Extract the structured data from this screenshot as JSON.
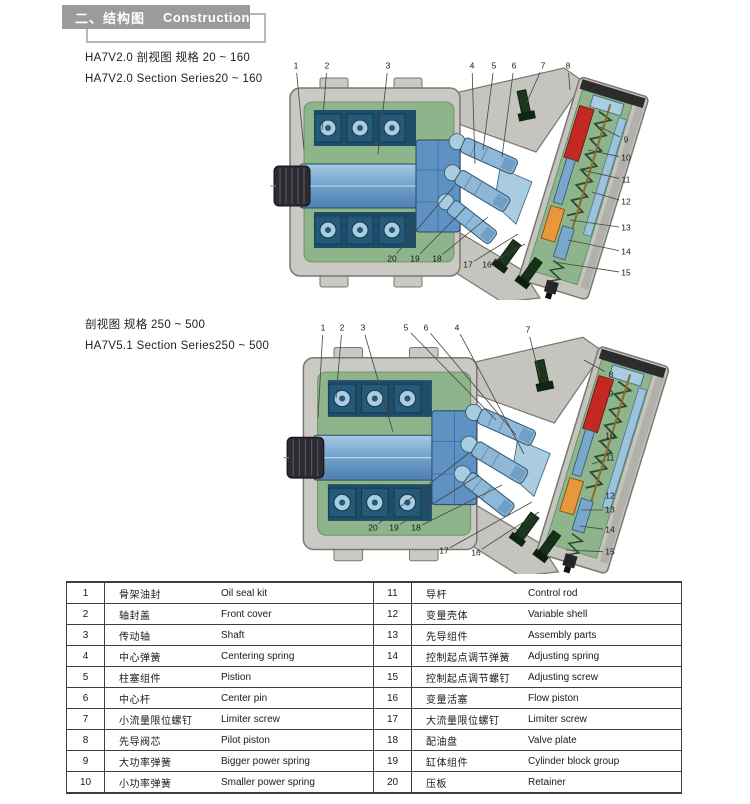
{
  "header": {
    "title_cn": "二、结构图",
    "title_en": "Construction",
    "box_color": "#9b9b9b"
  },
  "colors": {
    "housing_gray": "#cbc9c3",
    "interior_green": "#8db48a",
    "cylinder_blue": "#6f9fcb",
    "piston_lightblue": "#a9cce0",
    "spring_red": "#c32822",
    "piston_orange": "#e8973a",
    "bolt_darkgreen": "#1d351d"
  },
  "diagrams": [
    {
      "title_line1": "HA7V2.0 剖视图 规格 20 ~ 160",
      "title_line2": "HA7V2.0 Section Series20 ~ 160",
      "callouts": [
        {
          "label": "1",
          "nx": 26,
          "ny": 14,
          "tx": 34,
          "ty": 98
        },
        {
          "label": "2",
          "nx": 57,
          "ny": 14,
          "tx": 52,
          "ty": 78
        },
        {
          "label": "3",
          "nx": 118,
          "ny": 14,
          "tx": 108,
          "ty": 102
        },
        {
          "label": "4",
          "nx": 202,
          "ny": 14,
          "tx": 205,
          "ty": 112
        },
        {
          "label": "5",
          "nx": 224,
          "ny": 14,
          "tx": 213,
          "ty": 98
        },
        {
          "label": "6",
          "nx": 244,
          "ny": 14,
          "tx": 232,
          "ty": 105
        },
        {
          "label": "7",
          "nx": 273,
          "ny": 14,
          "tx": 256,
          "ty": 52
        },
        {
          "label": "8",
          "nx": 298,
          "ny": 14,
          "tx": 300,
          "ty": 38
        },
        {
          "label": "9",
          "nx": 356,
          "ny": 88,
          "tx": 330,
          "ty": 75
        },
        {
          "label": "10",
          "nx": 356,
          "ny": 106,
          "tx": 318,
          "ty": 98
        },
        {
          "label": "11",
          "nx": 356,
          "ny": 128,
          "tx": 312,
          "ty": 118
        },
        {
          "label": "12",
          "nx": 356,
          "ny": 150,
          "tx": 322,
          "ty": 140
        },
        {
          "label": "13",
          "nx": 356,
          "ny": 176,
          "tx": 300,
          "ty": 168
        },
        {
          "label": "14",
          "nx": 356,
          "ny": 200,
          "tx": 298,
          "ty": 188
        },
        {
          "label": "15",
          "nx": 356,
          "ny": 221,
          "tx": 284,
          "ty": 210
        },
        {
          "label": "20",
          "nx": 122,
          "ny": 207,
          "tx": 185,
          "ty": 133
        },
        {
          "label": "19",
          "nx": 145,
          "ny": 207,
          "tx": 196,
          "ty": 155
        },
        {
          "label": "18",
          "nx": 167,
          "ny": 207,
          "tx": 218,
          "ty": 165
        },
        {
          "label": "17",
          "nx": 198,
          "ny": 213,
          "tx": 248,
          "ty": 182
        },
        {
          "label": "16",
          "nx": 217,
          "ny": 213,
          "tx": 255,
          "ty": 192
        }
      ]
    },
    {
      "title_line1": "剖视图 规格 250 ~ 500",
      "title_line2": "HA7V5.1 Section Series250 ~ 500",
      "callouts": [
        {
          "label": "1",
          "nx": 45,
          "ny": 14,
          "tx": 40,
          "ty": 104
        },
        {
          "label": "2",
          "nx": 64,
          "ny": 14,
          "tx": 58,
          "ty": 84
        },
        {
          "label": "3",
          "nx": 85,
          "ny": 14,
          "tx": 115,
          "ty": 118
        },
        {
          "label": "5",
          "nx": 128,
          "ny": 14,
          "tx": 218,
          "ty": 106
        },
        {
          "label": "6",
          "nx": 148,
          "ny": 14,
          "tx": 238,
          "ty": 121
        },
        {
          "label": "4",
          "nx": 179,
          "ny": 14,
          "tx": 246,
          "ty": 140
        },
        {
          "label": "7",
          "nx": 250,
          "ny": 16,
          "tx": 262,
          "ty": 64
        },
        {
          "label": "8",
          "nx": 333,
          "ny": 61,
          "tx": 306,
          "ty": 46
        },
        {
          "label": "9",
          "nx": 333,
          "ny": 80,
          "tx": 328,
          "ty": 84
        },
        {
          "label": "10",
          "nx": 332,
          "ny": 122,
          "tx": 320,
          "ty": 128
        },
        {
          "label": "11",
          "nx": 332,
          "ny": 144,
          "tx": 314,
          "ty": 150
        },
        {
          "label": "12",
          "nx": 332,
          "ny": 182,
          "tx": 328,
          "ty": 176
        },
        {
          "label": "13",
          "nx": 332,
          "ny": 196,
          "tx": 303,
          "ty": 196
        },
        {
          "label": "14",
          "nx": 332,
          "ny": 216,
          "tx": 302,
          "ty": 212
        },
        {
          "label": "15",
          "nx": 332,
          "ny": 238,
          "tx": 288,
          "ty": 236
        },
        {
          "label": "20",
          "nx": 95,
          "ny": 214,
          "tx": 191,
          "ty": 139
        },
        {
          "label": "19",
          "nx": 116,
          "ny": 214,
          "tx": 201,
          "ty": 161
        },
        {
          "label": "18",
          "nx": 138,
          "ny": 214,
          "tx": 224,
          "ty": 171
        },
        {
          "label": "17",
          "nx": 166,
          "ny": 237,
          "tx": 254,
          "ty": 188
        },
        {
          "label": "16",
          "nx": 198,
          "ny": 239,
          "tx": 261,
          "ty": 198
        }
      ]
    }
  ],
  "table": {
    "parts": [
      {
        "no": "1",
        "cn": "骨架油封",
        "en": "Oil seal kit"
      },
      {
        "no": "2",
        "cn": "轴封盖",
        "en": "Front cover"
      },
      {
        "no": "3",
        "cn": "传动轴",
        "en": "Shaft"
      },
      {
        "no": "4",
        "cn": "中心弹簧",
        "en": "Centering spring"
      },
      {
        "no": "5",
        "cn": "柱塞组件",
        "en": "Pistion"
      },
      {
        "no": "6",
        "cn": "中心杆",
        "en": "Center pin"
      },
      {
        "no": "7",
        "cn": "小流量限位螺钉",
        "en": "Limiter screw"
      },
      {
        "no": "8",
        "cn": "先导阀芯",
        "en": "Pilot piston"
      },
      {
        "no": "9",
        "cn": "大功率弹簧",
        "en": "Bigger power spring"
      },
      {
        "no": "10",
        "cn": "小功率弹簧",
        "en": "Smaller power spring"
      },
      {
        "no": "11",
        "cn": "导杆",
        "en": "Control rod"
      },
      {
        "no": "12",
        "cn": "变量壳体",
        "en": "Variable shell"
      },
      {
        "no": "13",
        "cn": "先导组件",
        "en": "Assembly parts"
      },
      {
        "no": "14",
        "cn": "控制起点调节弹簧",
        "en": "Adjusting spring"
      },
      {
        "no": "15",
        "cn": "控制起点调节螺钉",
        "en": "Adjusting screw"
      },
      {
        "no": "16",
        "cn": "变量活塞",
        "en": "Flow piston"
      },
      {
        "no": "17",
        "cn": "大流量限位螺钉",
        "en": "Limiter screw"
      },
      {
        "no": "18",
        "cn": "配油盘",
        "en": "Valve plate"
      },
      {
        "no": "19",
        "cn": "缸体组件",
        "en": "Cylinder block group"
      },
      {
        "no": "20",
        "cn": "压板",
        "en": "Retainer"
      }
    ]
  }
}
